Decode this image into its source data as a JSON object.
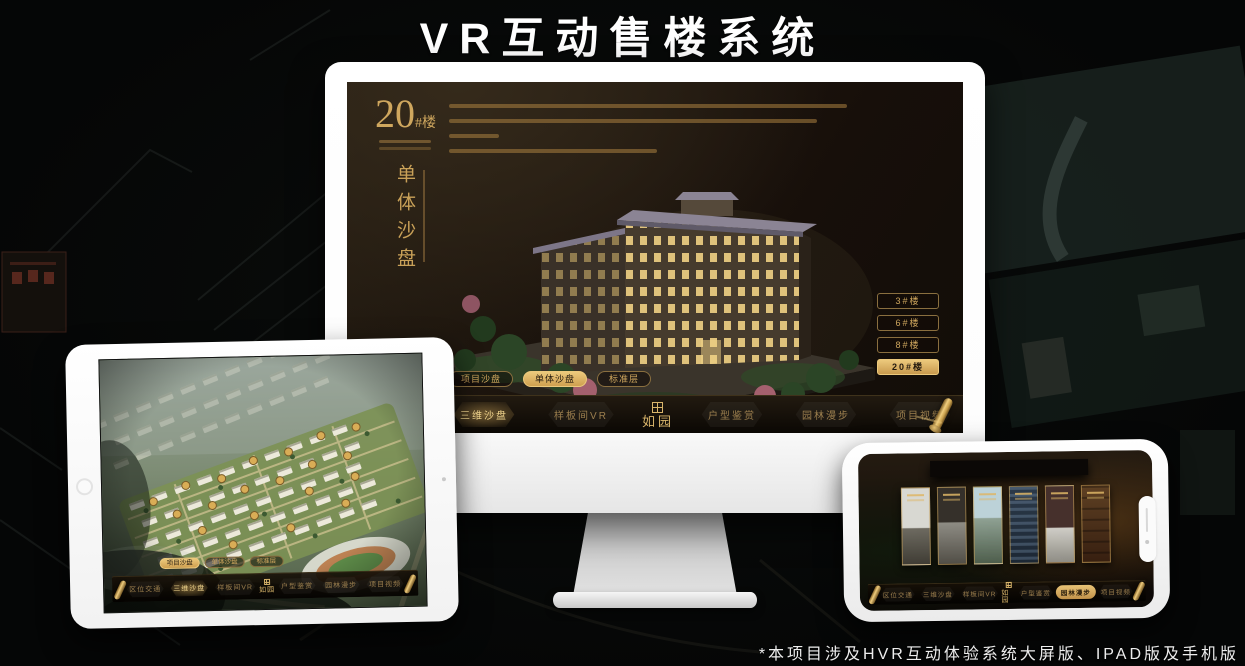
{
  "page": {
    "title": "VR互动售楼系统",
    "footnote": "*本项目涉及HVR互动体验系统大屏版、IPAD版及手机版"
  },
  "colors": {
    "gold": "#c9a158",
    "gold_bright": "#ecc97c",
    "nav_text": "#9c7f4e",
    "screen_bg": "#171009"
  },
  "brand": {
    "logo": "如园"
  },
  "nav_menu": {
    "items_left": [
      "区位交通",
      "三维沙盘",
      "样板间VR"
    ],
    "items_right": [
      "户型鉴赏",
      "园林漫步",
      "项目视频"
    ]
  },
  "monitor_app": {
    "building_number": "20",
    "building_number_suffix": "#楼",
    "section_title_vertical": "单体沙盘",
    "floor_buttons": [
      {
        "label": "3#楼",
        "active": false
      },
      {
        "label": "6#楼",
        "active": false
      },
      {
        "label": "8#楼",
        "active": false
      },
      {
        "label": "20#楼",
        "active": true
      }
    ],
    "sub_tabs": [
      {
        "label": "项目沙盘",
        "active": false
      },
      {
        "label": "单体沙盘",
        "active": true
      },
      {
        "label": "标准层",
        "active": false
      }
    ],
    "active_nav_item": "三维沙盘"
  },
  "tablet_app": {
    "sub_tabs": [
      {
        "label": "项目沙盘",
        "active": true
      },
      {
        "label": "单体沙盘",
        "active": false
      },
      {
        "label": "标准层",
        "active": false
      }
    ],
    "active_nav_item": "三维沙盘"
  },
  "phone_app": {
    "active_nav_item": "园林漫步"
  }
}
